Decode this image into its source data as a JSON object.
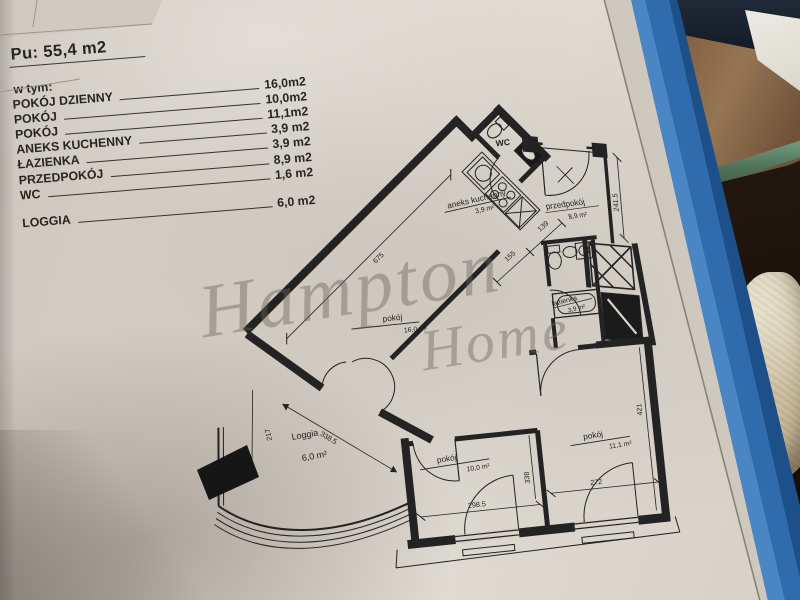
{
  "header": {
    "title": "Pu: 55,4 m2",
    "subtitle": "w tym:"
  },
  "rooms": [
    {
      "label": "POKÓJ DZIENNY",
      "value": "16,0m2"
    },
    {
      "label": "POKÓJ",
      "value": "10,0m2"
    },
    {
      "label": "POKÓJ",
      "value": "11,1m2"
    },
    {
      "label": "ANEKS KUCHENNY",
      "value": "3,9 m2"
    },
    {
      "label": "ŁAZIENKA",
      "value": "3,9 m2"
    },
    {
      "label": "PRZEDPOKÓJ",
      "value": "8,9 m2"
    },
    {
      "label": "WC",
      "value": "1,6 m2"
    },
    {
      "label": "LOGGIA",
      "value": "6,0 m2"
    }
  ],
  "watermark": {
    "word1": "Hampton",
    "word2": "Home"
  },
  "plan": {
    "labels": {
      "wc": "WC",
      "kitchen_name": "aneks kuchenny",
      "kitchen_area": "3,9 m²",
      "living_name": "pokój",
      "living_area": "16,0 m²",
      "hall_name": "przedpokój",
      "hall_area": "8,9 m²",
      "bath_name": "łazienka",
      "bath_area": "3,9 m²",
      "bed1_name": "pokój",
      "bed1_area": "10,0 m²",
      "bed2_name": "pokój",
      "bed2_area": "11,1 m²",
      "loggia_name": "Loggia",
      "loggia_area": "6,0 m²"
    },
    "dims": {
      "d675": "675",
      "d217": "217",
      "d338_5": "338.5",
      "d298_5": "298.5",
      "d338": "338",
      "d272": "272",
      "d421": "421",
      "d241_5": "241.5",
      "d155": "155",
      "d139": "139"
    }
  },
  "colors": {
    "paper": "#d8d2c9",
    "ink": "#232323",
    "binder_blue": "#2f6bad",
    "wood_brown": "#85674a",
    "sofa_beige": "#d6cab0",
    "glass_green": "#5c7d64"
  }
}
